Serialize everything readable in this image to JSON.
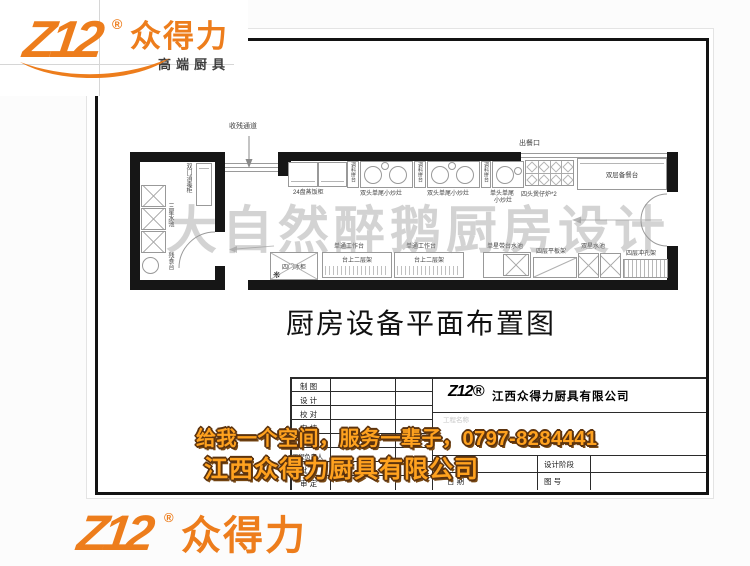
{
  "logo": {
    "mark": "Z12",
    "reg": "®",
    "name": "众得力",
    "tagline": "高端厨具"
  },
  "page": {
    "watermark": "大自然醉鹅厨房设计",
    "drawing_title": "厨房设备平面布置图"
  },
  "plan": {
    "corridor_label": "收残通道",
    "serving_label": "出餐口",
    "left_room": {
      "disinfect_cabinet": "双门消毒柜",
      "triple_sink": "三星水池",
      "waste_table": "残食台"
    },
    "top_row": {
      "steamer": "24盘蒸饭柜",
      "spice_counter": "调料拼台",
      "double_wok": "双头单尾小炒灶",
      "single_wok_line1": "单头单尾",
      "single_wok_line2": "小炒灶",
      "claypot": "四头煲仔炉*2",
      "prep_counter": "双层备餐台"
    },
    "bottom_row": {
      "fridge": "四门冰柜",
      "snowflake": "❋",
      "work_table": "单通工作台",
      "over_shelf": "台上二层架",
      "single_sink": "单星带台水池",
      "flat_shelf": "四层平板架",
      "double_sink": "双星水池",
      "punch_shelf": "四层冲孔架"
    }
  },
  "title_block": {
    "rows": [
      "制 图",
      "设 计",
      "校 对",
      "审 核",
      "审 定",
      "工程负责人",
      "批 准",
      "审 定"
    ],
    "logo_mark": "Z12®",
    "company": "江西众得力厨具有限公司",
    "project_label": "工程名称",
    "stage_label": "设计阶段",
    "date_label": "日 期",
    "no_label": "图 号"
  },
  "promo": {
    "line1": "给我一个空间，服务一辈子，0797-8284441",
    "line2": "江西众得力厨具有限公司"
  },
  "colors": {
    "brand_orange": "#ED7D1C",
    "promo_orange": "#FFA21F",
    "promo_outline": "#5C330E",
    "watermark_gray": "#969696"
  }
}
